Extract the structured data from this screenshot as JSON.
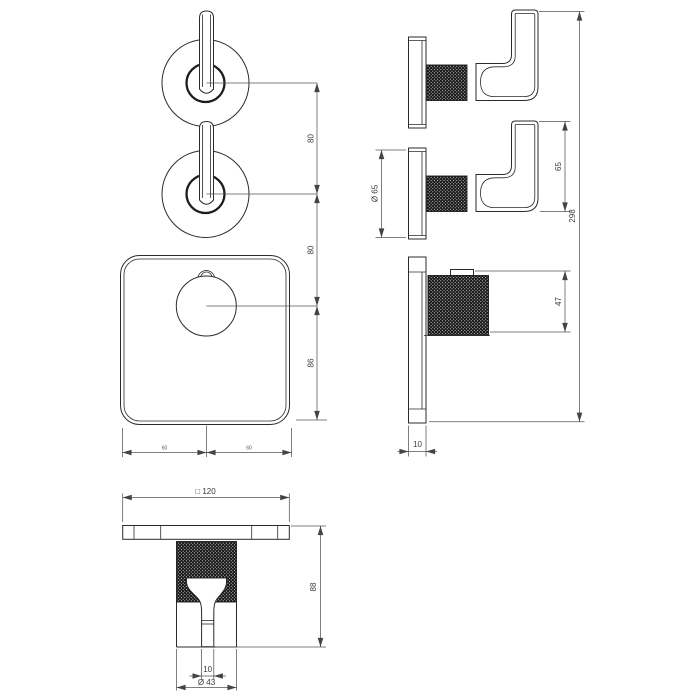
{
  "dimensions": {
    "front": {
      "handle_spacing": "80",
      "handle_to_knob": "80",
      "knob_to_bottom": "86",
      "half_left": "60",
      "half_right": "60"
    },
    "side": {
      "plate_diameter": "Ø 65",
      "handle_length": "65",
      "overall_height": "298",
      "knob_depth": "47",
      "plate_thickness": "10"
    },
    "bottom": {
      "plate_square": "□ 120",
      "body_height": "88",
      "spout_width": "10",
      "body_diameter": "Ø 43"
    }
  }
}
